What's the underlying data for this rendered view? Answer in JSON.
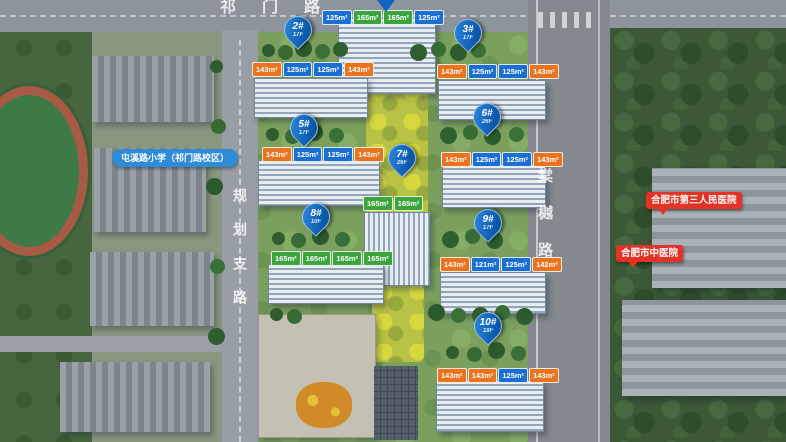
{
  "roads": {
    "top": "祁门路",
    "left": "规划支路",
    "right": "棠樾路"
  },
  "poi": {
    "school": "屯溪路小学（祁门路校区）",
    "hospital_1": "合肥市第三人民医院",
    "hospital_2": "合肥市中医院"
  },
  "colors": {
    "tag_blue": "#1b6ed2",
    "tag_orange": "#e9731e",
    "tag_green": "#3ca43c",
    "pin_blue": "#0f65c0",
    "poi_blue": "#2f8bd6",
    "poi_red": "#e23326"
  },
  "markers": [
    {
      "id": "2",
      "label": "2#",
      "floors": "17F",
      "x": 297,
      "y": 30
    },
    {
      "id": "3",
      "label": "3#",
      "floors": "17F",
      "x": 467,
      "y": 33
    },
    {
      "id": "5",
      "label": "5#",
      "floors": "17F",
      "x": 303,
      "y": 128
    },
    {
      "id": "6",
      "label": "6#",
      "floors": "26F",
      "x": 486,
      "y": 117
    },
    {
      "id": "7",
      "label": "7#",
      "floors": "26F",
      "x": 401,
      "y": 158
    },
    {
      "id": "8",
      "label": "8#",
      "floors": "10F",
      "x": 315,
      "y": 217
    },
    {
      "id": "9",
      "label": "9#",
      "floors": "17F",
      "x": 487,
      "y": 223
    },
    {
      "id": "10",
      "label": "10#",
      "floors": "18F",
      "x": 487,
      "y": 326
    }
  ],
  "tag_rows": [
    {
      "id": "1",
      "x": 322,
      "y": 10,
      "tags": [
        {
          "text": "125m²",
          "color": "blue"
        },
        {
          "text": "165m²",
          "color": "green"
        },
        {
          "text": "165m²",
          "color": "green"
        },
        {
          "text": "125m²",
          "color": "blue"
        }
      ]
    },
    {
      "id": "2",
      "x": 252,
      "y": 62,
      "tags": [
        {
          "text": "143m²",
          "color": "orange"
        },
        {
          "text": "125m²",
          "color": "blue"
        },
        {
          "text": "125m²",
          "color": "blue"
        },
        {
          "text": "143m²",
          "color": "orange"
        }
      ]
    },
    {
      "id": "3",
      "x": 437,
      "y": 64,
      "tags": [
        {
          "text": "143m²",
          "color": "orange"
        },
        {
          "text": "125m²",
          "color": "blue"
        },
        {
          "text": "125m²",
          "color": "blue"
        },
        {
          "text": "143m²",
          "color": "orange"
        }
      ]
    },
    {
      "id": "5",
      "x": 262,
      "y": 147,
      "tags": [
        {
          "text": "143m²",
          "color": "orange"
        },
        {
          "text": "125m²",
          "color": "blue"
        },
        {
          "text": "125m²",
          "color": "blue"
        },
        {
          "text": "143m²",
          "color": "orange"
        }
      ]
    },
    {
      "id": "6",
      "x": 441,
      "y": 152,
      "tags": [
        {
          "text": "143m²",
          "color": "orange"
        },
        {
          "text": "125m²",
          "color": "blue"
        },
        {
          "text": "125m²",
          "color": "blue"
        },
        {
          "text": "143m²",
          "color": "orange"
        }
      ]
    },
    {
      "id": "7",
      "x": 363,
      "y": 196,
      "tags": [
        {
          "text": "165m²",
          "color": "green"
        },
        {
          "text": "165m²",
          "color": "green"
        }
      ]
    },
    {
      "id": "8",
      "x": 271,
      "y": 251,
      "tags": [
        {
          "text": "165m²",
          "color": "green"
        },
        {
          "text": "165m²",
          "color": "green"
        },
        {
          "text": "165m²",
          "color": "green"
        },
        {
          "text": "165m²",
          "color": "green"
        }
      ]
    },
    {
      "id": "9",
      "x": 440,
      "y": 257,
      "tags": [
        {
          "text": "143m²",
          "color": "orange"
        },
        {
          "text": "121m²",
          "color": "blue"
        },
        {
          "text": "125m²",
          "color": "blue"
        },
        {
          "text": "142m²",
          "color": "orange"
        }
      ]
    },
    {
      "id": "10",
      "x": 437,
      "y": 368,
      "tags": [
        {
          "text": "143m²",
          "color": "orange"
        },
        {
          "text": "143m²",
          "color": "orange"
        },
        {
          "text": "125m²",
          "color": "blue"
        },
        {
          "text": "143m²",
          "color": "orange"
        }
      ]
    }
  ]
}
